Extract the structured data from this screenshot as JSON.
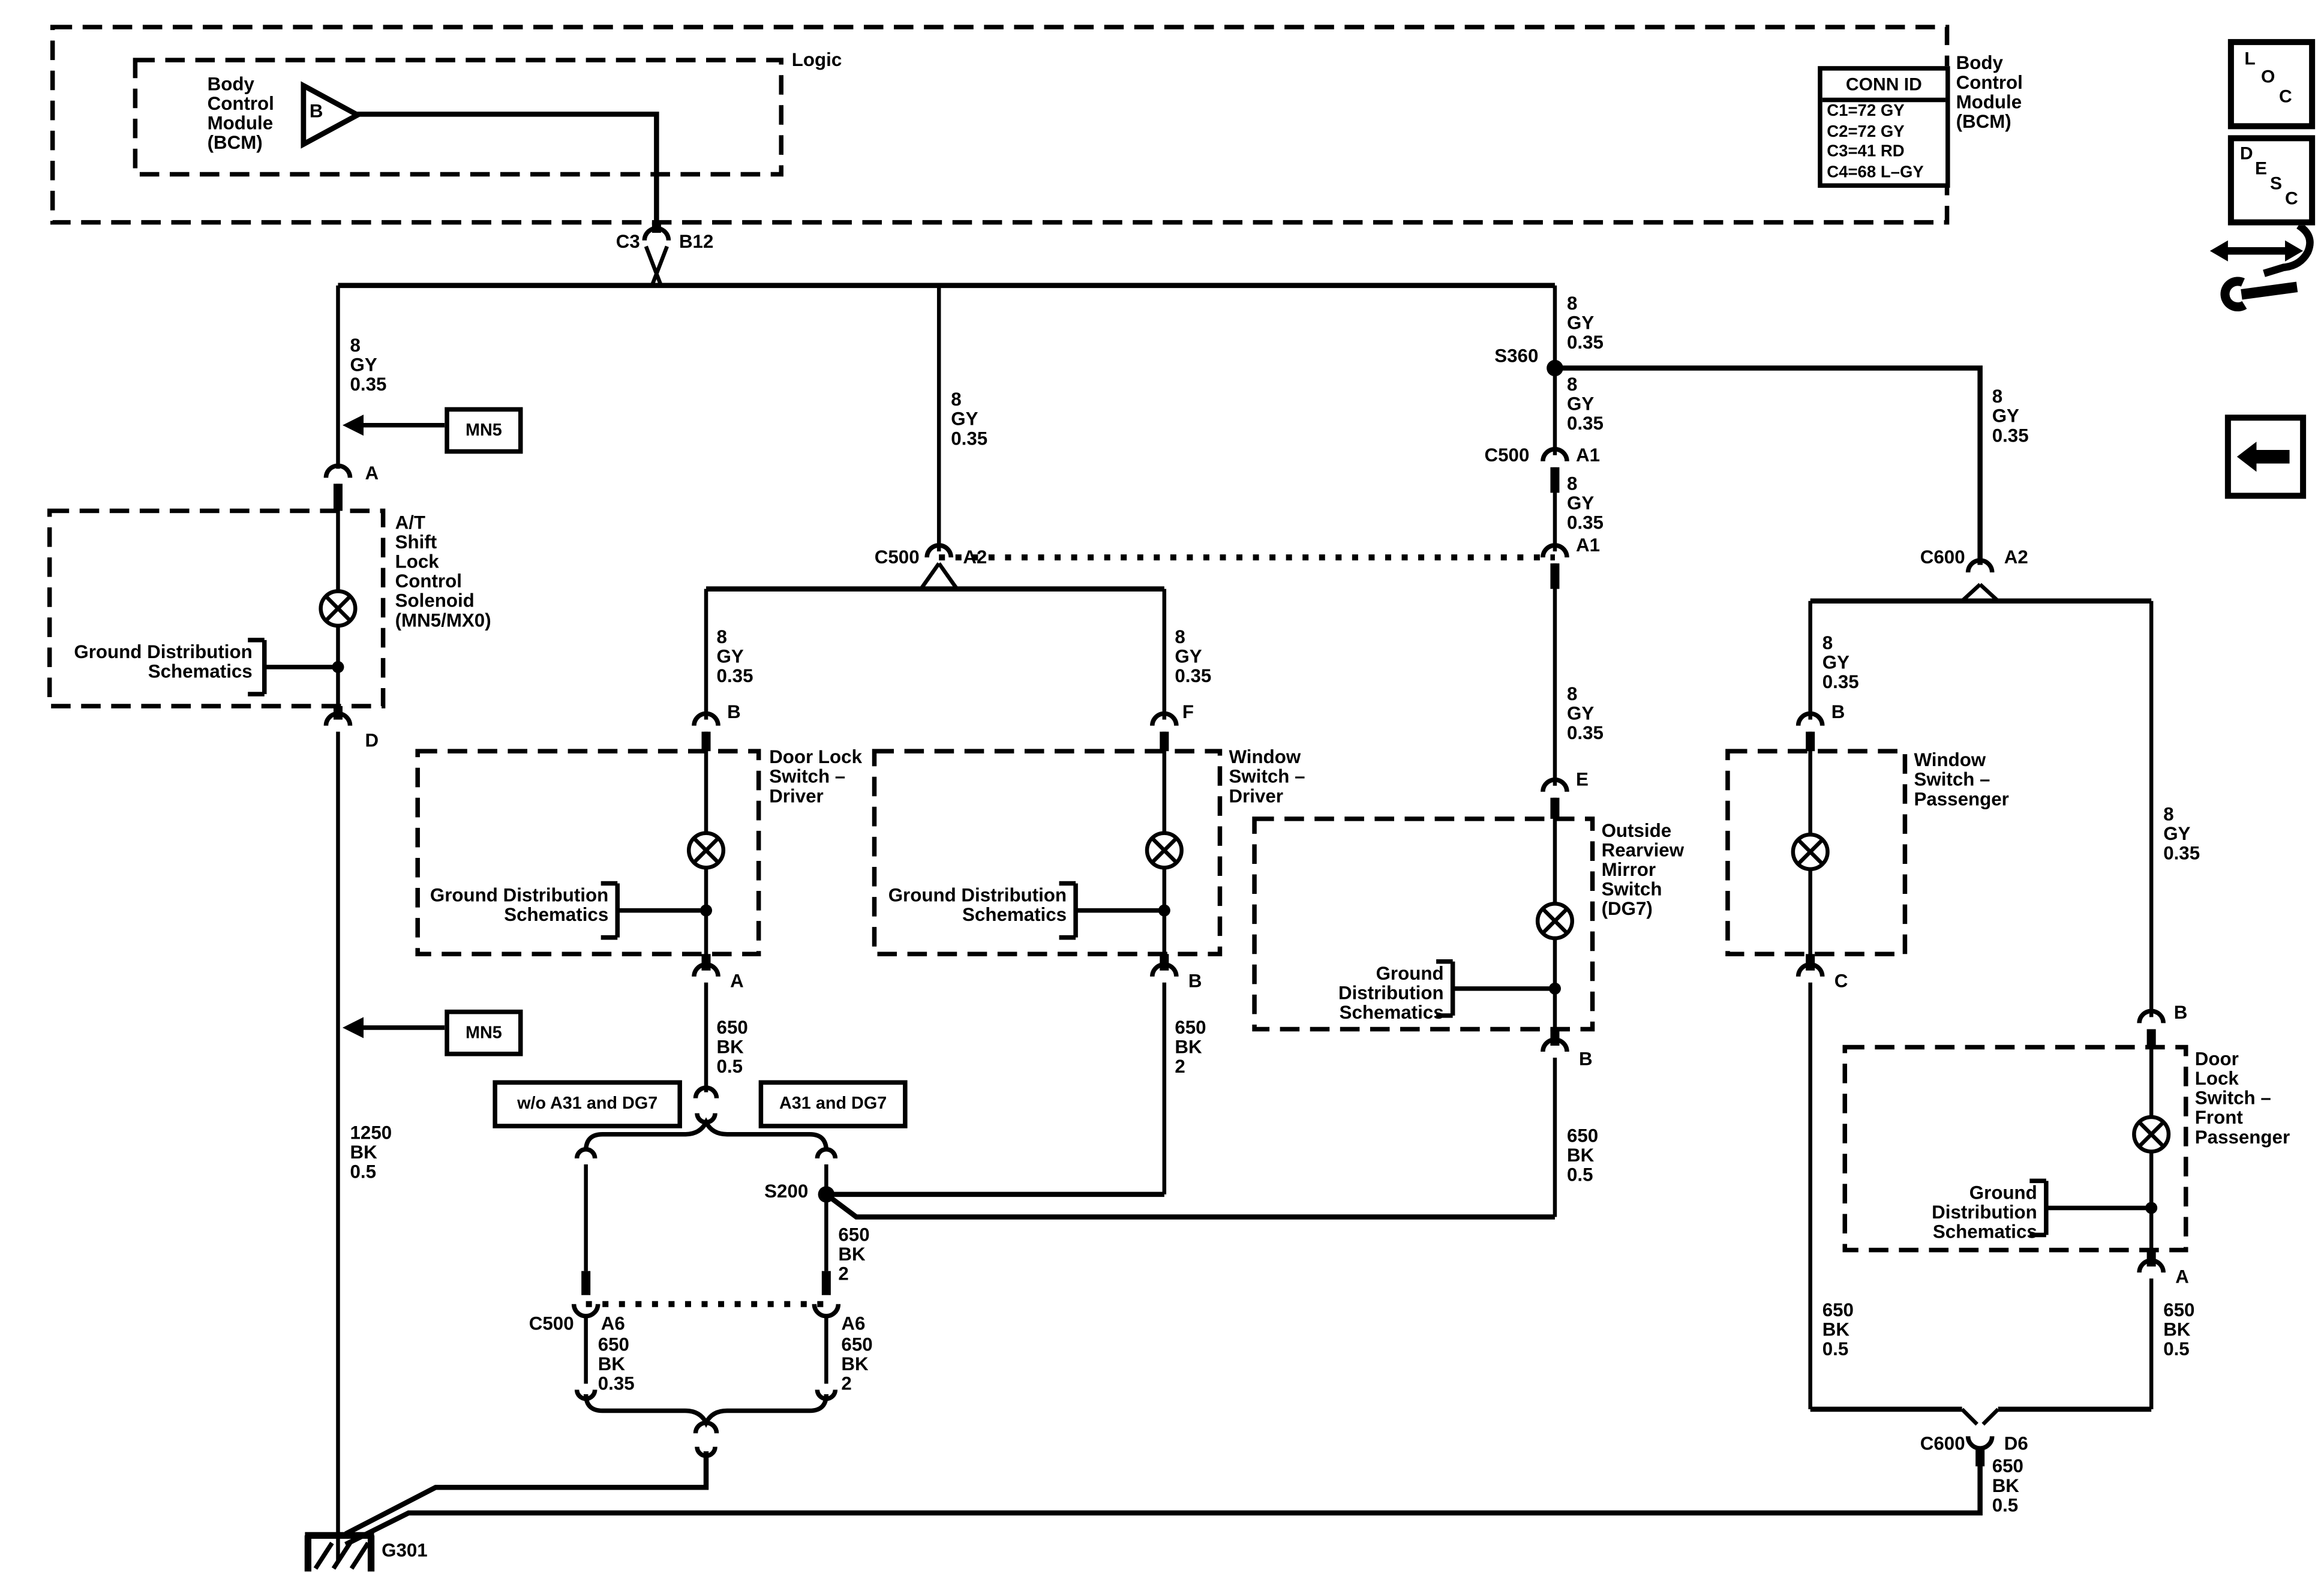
{
  "header": {
    "logic_label": "Logic",
    "bcm_inner_label": "Body\nControl\nModule\n(BCM)",
    "bcm_gate_letter": "B",
    "bcm_outer_label": "Body\nControl\nModule\n(BCM)",
    "conn_id": {
      "title": "CONN ID",
      "rows": [
        "C1=72 GY",
        "C2=72 GY",
        "C3=41 RD",
        "C4=68 L–GY"
      ]
    }
  },
  "icons": {
    "loc": [
      "L",
      "O",
      "C"
    ],
    "desc": [
      "D",
      "E",
      "S",
      "C"
    ]
  },
  "components": {
    "shift_lock": "A/T\nShift\nLock\nControl\nSolenoid\n(MN5/MX0)",
    "door_lock_driver": "Door Lock\nSwitch –\nDriver",
    "window_driver": "Window\nSwitch –\nDriver",
    "mirror_switch": "Outside\nRearview\nMirror\nSwitch\n(DG7)",
    "window_passenger": "Window\nSwitch –\nPassenger",
    "door_lock_front_passenger": "Door\nLock\nSwitch –\nFront\nPassenger",
    "ground_ref": "Ground Distribution\nSchematics",
    "mn5": "MN5",
    "option_without": "w/o A31 and DG7",
    "option_with": "A31 and DG7"
  },
  "wire_labels": {
    "gy8": "8\nGY\n0.35",
    "bk1250": "1250\nBK\n0.5",
    "bk650_05": "650\nBK\n0.5",
    "bk650_2": "650\nBK\n2",
    "bk650_035": "650\nBK\n0.35"
  },
  "connectors": {
    "c3": "C3",
    "b12": "B12",
    "s360": "S360",
    "s200": "S200",
    "c500": "C500",
    "c600": "C600",
    "g301": "G301",
    "a": "A",
    "b": "B",
    "c": "C",
    "d": "D",
    "e": "E",
    "f": "F",
    "a1": "A1",
    "a2": "A2",
    "a6": "A6",
    "d6": "D6"
  }
}
